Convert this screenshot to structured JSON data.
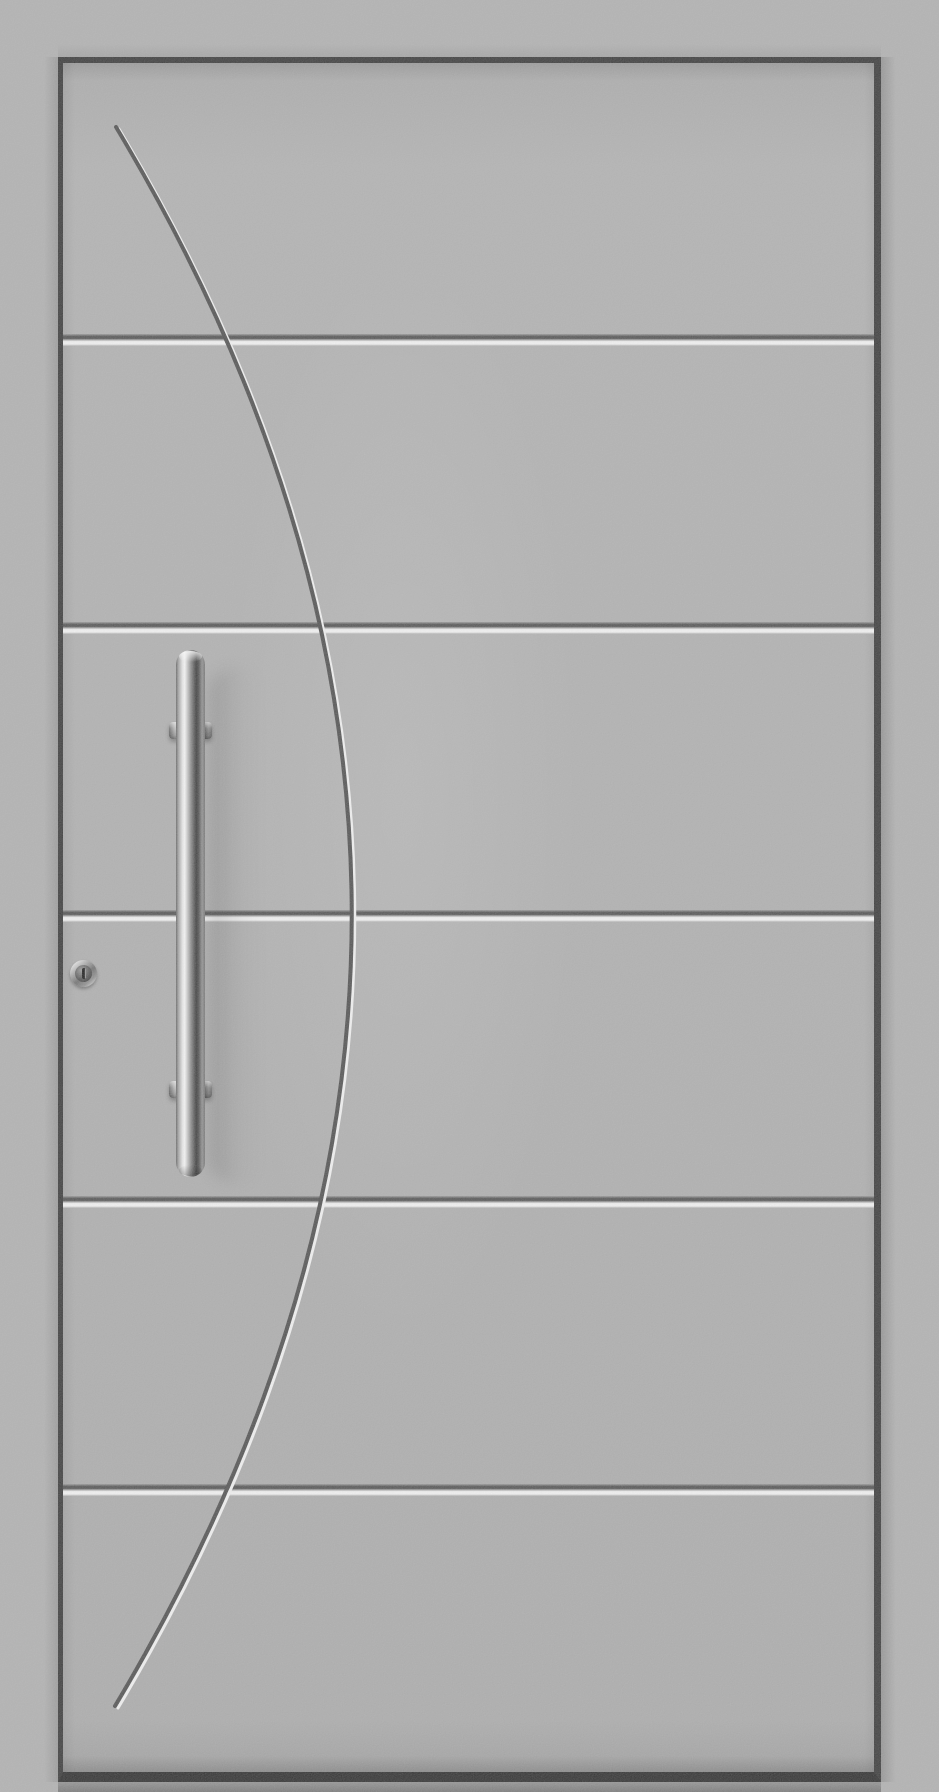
{
  "scene": {
    "description": "Product render of a grey aluminium entrance door with five horizontal engraved grooves, a tall engraved decorative arc, a vertical stainless-steel pull handle and a chrome lock cylinder",
    "width_px": 939,
    "height_px": 1792
  },
  "door": {
    "colors": {
      "frame": "#aeaeae",
      "panel": "#acacac",
      "outline": "#323232",
      "groove_dark": "#4c4c4c",
      "groove_light": "#f3f3f3",
      "bottom_rail": "#262626",
      "threshold": "#737373"
    },
    "leaf_outline": {
      "left": 58,
      "top": 57,
      "right": 881,
      "bottom": 1782
    },
    "grooves": {
      "count": 5,
      "dark_line_y": [
        336,
        624,
        912,
        1198,
        1486
      ]
    },
    "decor_curve": {
      "start": [
        116,
        127
      ],
      "control": [
        588,
        915
      ],
      "end": [
        115,
        1706
      ],
      "apex_x": 352,
      "dark_color": "#4a4a4a",
      "highlight_color": "#f2f2f2"
    }
  },
  "hardware": {
    "handle": {
      "type": "vertical-bar-pull",
      "finish": "stainless-steel",
      "bar": {
        "left": 176,
        "top": 650,
        "width": 29,
        "height": 527
      },
      "bracket": {
        "left": 169,
        "width": 43,
        "height": 17
      },
      "bracket_tops_y": [
        722,
        1081
      ]
    },
    "lock_cylinder": {
      "left": 70,
      "top": 960,
      "size": 27,
      "finish": "chrome"
    }
  }
}
